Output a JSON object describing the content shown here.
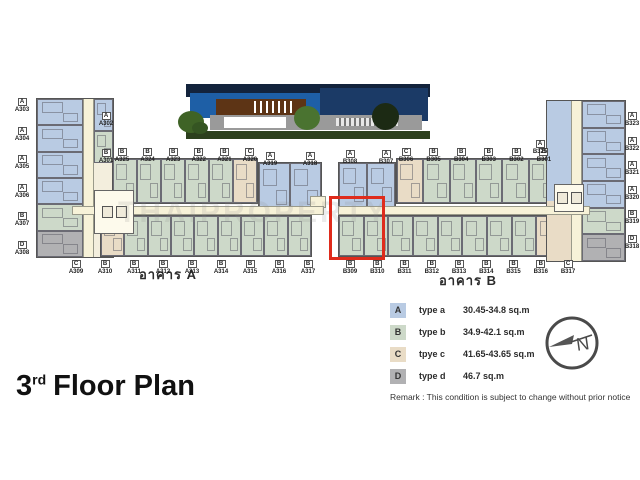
{
  "title": {
    "number": "3",
    "suffix": "rd",
    "text": "Floor Plan"
  },
  "watermark": "THAIPROPERTY",
  "remark": "Remark : This condition is subject to change without prior notice",
  "compass": {
    "label": "N"
  },
  "colors": {
    "type_a": "#b9cbe3",
    "type_b": "#cdd9c9",
    "type_c": "#e9dcc6",
    "type_d": "#b1b1b3",
    "corridor": "#f7f2d8",
    "highlight": "#df2b1c"
  },
  "legend": {
    "items": [
      {
        "letter": "A",
        "label": "type a",
        "range": "30.45-34.8 sq.m"
      },
      {
        "letter": "B",
        "label": "type b",
        "range": "34.9-42.1 sq.m"
      },
      {
        "letter": "C",
        "label": "tpye c",
        "range": "41.65-43.65 sq.m"
      },
      {
        "letter": "D",
        "label": "type d",
        "range": "46.7 sq.m"
      }
    ]
  },
  "buildings": {
    "a": {
      "label": "อาคาร A",
      "left_units": [
        {
          "id": "A303",
          "type": "A"
        },
        {
          "id": "A304",
          "type": "A"
        },
        {
          "id": "A305",
          "type": "A"
        },
        {
          "id": "A306",
          "type": "A"
        },
        {
          "id": "A307",
          "type": "B"
        },
        {
          "id": "A308",
          "type": "D"
        }
      ],
      "right_units": [
        {
          "id": "A302",
          "type": "A"
        },
        {
          "id": "A301",
          "type": "B"
        }
      ],
      "top_units": [
        {
          "id": "A325",
          "type": "B"
        },
        {
          "id": "A324",
          "type": "B"
        },
        {
          "id": "A323",
          "type": "B"
        },
        {
          "id": "A322",
          "type": "B"
        },
        {
          "id": "A321",
          "type": "B"
        },
        {
          "id": "A320",
          "type": "C"
        }
      ],
      "end_units": [
        {
          "id": "A319",
          "type": "A"
        },
        {
          "id": "A318",
          "type": "A"
        }
      ],
      "bottom_units": [
        {
          "id": "A309",
          "type": "C"
        },
        {
          "id": "A310",
          "type": "B"
        },
        {
          "id": "A311",
          "type": "B"
        },
        {
          "id": "A312",
          "type": "B"
        },
        {
          "id": "A313",
          "type": "B"
        },
        {
          "id": "A314",
          "type": "B"
        },
        {
          "id": "A315",
          "type": "B"
        },
        {
          "id": "A316",
          "type": "B"
        },
        {
          "id": "A317",
          "type": "B"
        }
      ]
    },
    "b": {
      "label": "อาคาร B",
      "end_units": [
        {
          "id": "B308",
          "type": "A"
        },
        {
          "id": "B307",
          "type": "A"
        }
      ],
      "top_units": [
        {
          "id": "B306",
          "type": "C"
        },
        {
          "id": "B305",
          "type": "B"
        },
        {
          "id": "B304",
          "type": "B"
        },
        {
          "id": "B303",
          "type": "B"
        },
        {
          "id": "B302",
          "type": "B"
        },
        {
          "id": "B301",
          "type": "B"
        }
      ],
      "bottom_units": [
        {
          "id": "B309",
          "type": "B",
          "highlighted": true
        },
        {
          "id": "B310",
          "type": "B"
        },
        {
          "id": "B311",
          "type": "B"
        },
        {
          "id": "B312",
          "type": "B"
        },
        {
          "id": "B313",
          "type": "B"
        },
        {
          "id": "B314",
          "type": "B"
        },
        {
          "id": "B315",
          "type": "B"
        },
        {
          "id": "B316",
          "type": "B"
        },
        {
          "id": "B317",
          "type": "C"
        }
      ],
      "wing_left_units": [
        {
          "id": "B325",
          "type": "A"
        }
      ],
      "wing_right_units": [
        {
          "id": "B323",
          "type": "A"
        },
        {
          "id": "B322",
          "type": "A"
        },
        {
          "id": "B321",
          "type": "A"
        },
        {
          "id": "B320",
          "type": "A"
        },
        {
          "id": "B319",
          "type": "B"
        },
        {
          "id": "B318",
          "type": "D"
        }
      ]
    }
  }
}
